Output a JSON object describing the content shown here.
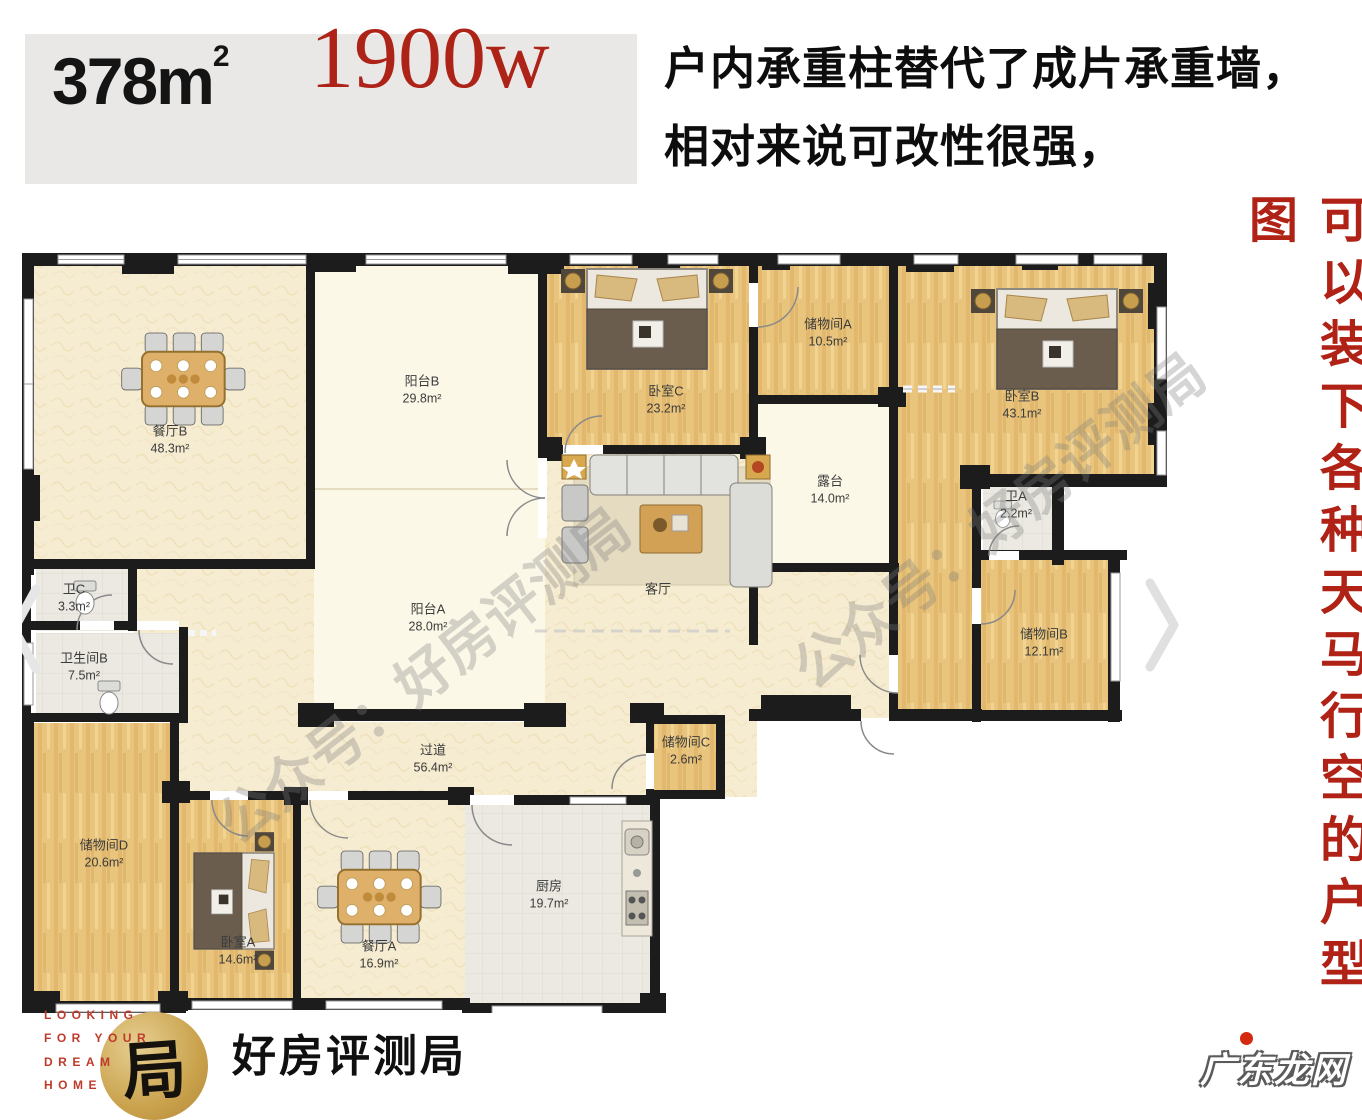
{
  "header": {
    "area_value": "378",
    "area_unit": "m",
    "area_sup": "2",
    "price": "1900w",
    "note_line1": "户内承重柱替代了成片承重墙，",
    "note_line2": "相对来说可改性很强，"
  },
  "side_note": "可以装下各种天马行空的户型图",
  "plan": {
    "watermark": "公众号：好房评测局",
    "rooms": [
      {
        "name": "餐厅B",
        "area": "48.3m²"
      },
      {
        "name": "阳台B",
        "area": "29.8m²"
      },
      {
        "name": "卧室C",
        "area": "23.2m²"
      },
      {
        "name": "储物间A",
        "area": "10.5m²"
      },
      {
        "name": "卧室B",
        "area": "43.1m²"
      },
      {
        "name": "露台",
        "area": "14.0m²"
      },
      {
        "name": "卫A",
        "area": "2.2m²"
      },
      {
        "name": "储物间B",
        "area": "12.1m²"
      },
      {
        "name": "客厅",
        "area": ""
      },
      {
        "name": "阳台A",
        "area": "28.0m²"
      },
      {
        "name": "卫C",
        "area": "3.3m²"
      },
      {
        "name": "卫生间B",
        "area": "7.5m²"
      },
      {
        "name": "过道",
        "area": "56.4m²"
      },
      {
        "name": "储物间C",
        "area": "2.6m²"
      },
      {
        "name": "储物间D",
        "area": "20.6m²"
      },
      {
        "name": "卧室A",
        "area": "14.6m²"
      },
      {
        "name": "餐厅A",
        "area": "16.9m²"
      },
      {
        "name": "厨房",
        "area": "19.7m²"
      }
    ]
  },
  "footer": {
    "logo_lines": [
      "LOOKING",
      "FOR YOUR",
      "DREAM",
      "HOME"
    ],
    "logo_seal": "局",
    "brand": "好房评测局"
  },
  "corner_watermark": "广东龙网",
  "colors": {
    "price_red": "#ad2318",
    "side_red": "#b02116",
    "wall": "#1c1c1c",
    "wood_floor": "#e8c47d",
    "cream_floor": "#f6ecd1",
    "tile_floor": "#ebe9e2",
    "balcony_floor": "#fcf8e8"
  }
}
